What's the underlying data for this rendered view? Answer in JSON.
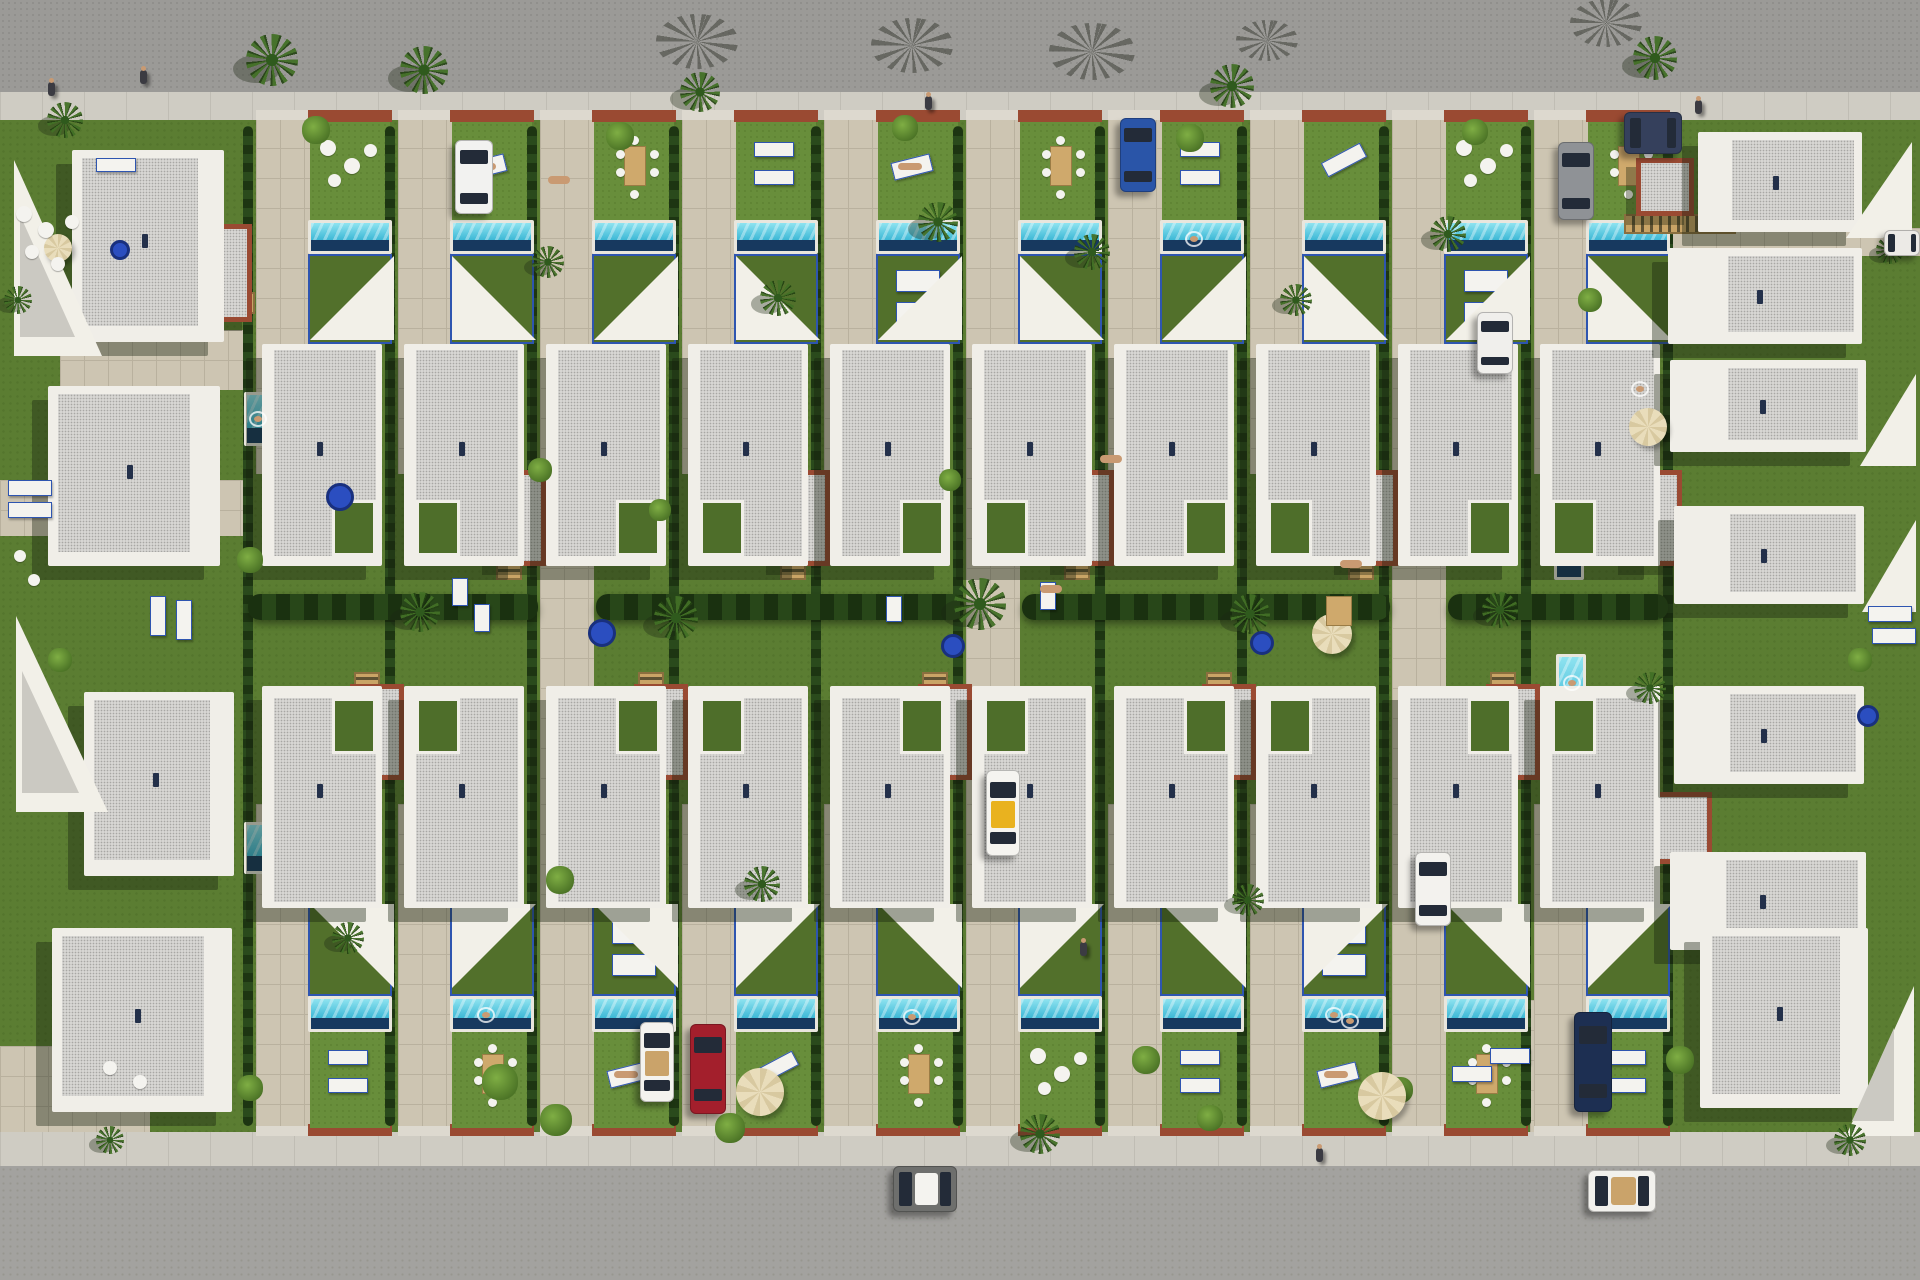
{
  "scene": {
    "kind": "aerial-3d-render",
    "subject": "villa-development-site-plan",
    "width": 1920,
    "height": 1280
  },
  "palette": {
    "road_top": "#9b9a97",
    "road_bottom": "#a3a29f",
    "sidewalk": "#cfccc3",
    "lawn": "#5b7d32",
    "lawn_light": "#688e3b",
    "lawn_terrace": "#52702b",
    "hedge": "#24411a",
    "paving": "#cdc5b2",
    "roof": "#d7d6d3",
    "parapet": "#f0eee8",
    "terracotta": "#9a4a32",
    "wood": "#c9a466",
    "pool": "#3db8d6",
    "pool_deep": "#17395f",
    "coping": "#e9e6dd",
    "sail": "#f2f0e8",
    "frame_blue": "#2e55b0",
    "table_blue": "#2b4ec0",
    "umbrella": "#e6d9b4",
    "taxi_yellow": "#e9b21f",
    "car_red": "#a31f2c",
    "car_navy": "#1d2f52",
    "car_blue": "#2a55a8",
    "skin": "#c99a72"
  },
  "roads": {
    "top": {
      "x": 0,
      "y": 0,
      "w": 1920,
      "h": 92
    },
    "bottom": {
      "x": 0,
      "y": 1166,
      "w": 1920,
      "h": 114
    }
  },
  "sidewalks": {
    "top": {
      "x": 0,
      "y": 92,
      "w": 1920,
      "h": 28
    },
    "bottom": {
      "x": 0,
      "y": 1132,
      "w": 1920,
      "h": 34
    }
  },
  "block": {
    "x": 0,
    "y": 120,
    "w": 1920,
    "h": 1012
  },
  "paving_extra": [
    {
      "x": 540,
      "y": 118,
      "w": 54,
      "h": 1014
    },
    {
      "x": 966,
      "y": 118,
      "w": 54,
      "h": 1014
    },
    {
      "x": 1392,
      "y": 118,
      "w": 54,
      "h": 1014
    },
    {
      "x": 0,
      "y": 480,
      "w": 248,
      "h": 56
    },
    {
      "x": 1620,
      "y": 228,
      "w": 300,
      "h": 28
    },
    {
      "x": 0,
      "y": 1046,
      "w": 150,
      "h": 86
    },
    {
      "x": 1530,
      "y": 1000,
      "w": 140,
      "h": 132
    },
    {
      "x": 60,
      "y": 330,
      "w": 190,
      "h": 60
    }
  ],
  "driveways": {
    "xs": [
      256,
      398,
      540,
      682,
      824,
      966,
      1108,
      1250,
      1392,
      1534
    ],
    "top": {
      "y": 118,
      "h": 356,
      "w": 54
    },
    "bottom": {
      "y": 804,
      "h": 328,
      "w": 54
    }
  },
  "curbs": {
    "terracotta_xs": [
      308,
      450,
      592,
      734,
      876,
      1018,
      1160,
      1302,
      1444,
      1586
    ],
    "light_xs": [
      256,
      398,
      540,
      682,
      824,
      966,
      1108,
      1250,
      1392,
      1534
    ],
    "top_y": 110,
    "bottom_y": 1124,
    "tw": 84,
    "lw": 52,
    "h": 12
  },
  "hedges_v": {
    "xs": [
      243,
      385,
      527,
      669,
      811,
      953,
      1095,
      1237,
      1379,
      1521,
      1663
    ],
    "y": 126,
    "w": 10,
    "h": 1000
  },
  "hedge_mid": [
    {
      "x": 248,
      "y": 594,
      "w": 290,
      "h": 26
    },
    {
      "x": 596,
      "y": 594,
      "w": 368,
      "h": 26
    },
    {
      "x": 1022,
      "y": 594,
      "w": 368,
      "h": 26
    },
    {
      "x": 1448,
      "y": 594,
      "w": 220,
      "h": 26
    }
  ],
  "gardens": {
    "xs": [
      310,
      452,
      594,
      736,
      878,
      1020,
      1162,
      1304,
      1446,
      1588
    ],
    "w": 80,
    "h": 98,
    "top_y": 122,
    "bottom_y": 1030,
    "top_furniture": [
      "roundchairs",
      "sunbed",
      "dining",
      "loungers2",
      "sunbed",
      "dining",
      "loungers2",
      "lounger1",
      "roundchairs",
      "dining"
    ],
    "bottom_furniture": [
      "loungers2",
      "dining",
      "sunbed",
      "lounger1",
      "dining",
      "roundchairs",
      "loungers2",
      "sunbed",
      "dining",
      "loungers2"
    ]
  },
  "pools_h": {
    "xs": [
      308,
      450,
      592,
      734,
      876,
      1018,
      1160,
      1302,
      1444,
      1586
    ],
    "w": 84,
    "top": {
      "y": 220,
      "h": 34
    },
    "bottom": {
      "y": 996,
      "h": 36
    }
  },
  "pools_v": [
    {
      "x": 244,
      "y": 392,
      "w": 26,
      "h": 54
    },
    {
      "x": 244,
      "y": 822,
      "w": 26,
      "h": 52
    },
    {
      "x": 1322,
      "y": 396,
      "w": 30,
      "h": 72
    },
    {
      "x": 1554,
      "y": 496,
      "w": 30,
      "h": 84
    },
    {
      "x": 1556,
      "y": 654,
      "w": 30,
      "h": 90
    },
    {
      "x": 1622,
      "y": 288,
      "w": 30,
      "h": 48
    },
    {
      "x": 1624,
      "y": 360,
      "w": 32,
      "h": 56
    }
  ],
  "terraces": {
    "xs": [
      308,
      450,
      592,
      734,
      876,
      1018,
      1160,
      1302,
      1444,
      1586
    ],
    "w": 84,
    "top": {
      "y": 254,
      "h": 90
    },
    "bottom": {
      "y": 906,
      "h": 90
    },
    "beds_top": [
      876,
      1444
    ],
    "beds_bottom": [
      592,
      1302
    ]
  },
  "sails_row": {
    "top": {
      "y": 256,
      "s": 84,
      "dirs": [
        "se",
        "sw",
        "se",
        "sw",
        "se",
        "sw",
        "se",
        "sw",
        "se",
        "sw"
      ]
    },
    "bottom": {
      "y": 904,
      "s": 84,
      "dirs": [
        "ne",
        "nw",
        "ne",
        "nw",
        "ne",
        "nw",
        "ne",
        "nw",
        "ne",
        "nw"
      ]
    },
    "xs": [
      310,
      452,
      594,
      736,
      878,
      1020,
      1162,
      1304,
      1446,
      1588
    ]
  },
  "houses": {
    "xs": [
      262,
      404,
      546,
      688,
      830,
      972,
      1114,
      1256,
      1398,
      1540
    ],
    "w": 120,
    "h": 222,
    "top_y": 344,
    "bottom_y": 686,
    "top_notches": [
      "br",
      "bl",
      "br",
      "bl",
      "br",
      "bl",
      "br",
      "bl",
      "br",
      "bl"
    ],
    "bottom_notches": [
      "tr",
      "tl",
      "tr",
      "tl",
      "tr",
      "tl",
      "tr",
      "tl",
      "tr",
      "tl"
    ]
  },
  "annexes": [
    {
      "x": 492,
      "y": 470,
      "w": 54,
      "h": 96
    },
    {
      "x": 776,
      "y": 470,
      "w": 54,
      "h": 96
    },
    {
      "x": 1060,
      "y": 470,
      "w": 54,
      "h": 96
    },
    {
      "x": 1344,
      "y": 470,
      "w": 54,
      "h": 96
    },
    {
      "x": 1628,
      "y": 470,
      "w": 54,
      "h": 96
    },
    {
      "x": 350,
      "y": 684,
      "w": 54,
      "h": 96
    },
    {
      "x": 634,
      "y": 684,
      "w": 54,
      "h": 96
    },
    {
      "x": 918,
      "y": 684,
      "w": 54,
      "h": 96
    },
    {
      "x": 1202,
      "y": 684,
      "w": 54,
      "h": 96
    },
    {
      "x": 1486,
      "y": 684,
      "w": 54,
      "h": 96
    },
    {
      "x": 206,
      "y": 224,
      "w": 46,
      "h": 98
    },
    {
      "x": 1636,
      "y": 158,
      "w": 58,
      "h": 58
    },
    {
      "x": 1634,
      "y": 792,
      "w": 78,
      "h": 72
    }
  ],
  "stairs_v": [
    {
      "x": 496,
      "y": 492
    },
    {
      "x": 780,
      "y": 492
    },
    {
      "x": 1064,
      "y": 492
    },
    {
      "x": 1348,
      "y": 492
    },
    {
      "x": 354,
      "y": 672
    },
    {
      "x": 638,
      "y": 672
    },
    {
      "x": 922,
      "y": 672
    },
    {
      "x": 1206,
      "y": 672
    },
    {
      "x": 1490,
      "y": 672
    }
  ],
  "stairs_h": [
    {
      "x": 155,
      "y": 292,
      "w": 100,
      "h": 22
    },
    {
      "x": 1624,
      "y": 214,
      "w": 112,
      "h": 20
    }
  ],
  "villas": [
    {
      "x": 72,
      "y": 150,
      "w": 152,
      "h": 192,
      "wl": 10,
      "wt": 8,
      "wr": 26,
      "wb": 16
    },
    {
      "x": 48,
      "y": 386,
      "w": 172,
      "h": 180,
      "wl": 10,
      "wt": 8,
      "wr": 30,
      "wb": 14
    },
    {
      "x": 84,
      "y": 692,
      "w": 150,
      "h": 184,
      "wl": 10,
      "wt": 8,
      "wr": 24,
      "wb": 16
    },
    {
      "x": 52,
      "y": 928,
      "w": 180,
      "h": 184,
      "wl": 10,
      "wt": 8,
      "wr": 28,
      "wb": 16
    },
    {
      "x": 1698,
      "y": 132,
      "w": 164,
      "h": 100,
      "wl": 34,
      "wt": 8,
      "wr": 8,
      "wb": 12
    },
    {
      "x": 1668,
      "y": 248,
      "w": 194,
      "h": 96,
      "wl": 60,
      "wt": 8,
      "wr": 8,
      "wb": 12
    },
    {
      "x": 1670,
      "y": 360,
      "w": 196,
      "h": 92,
      "wl": 58,
      "wt": 8,
      "wr": 8,
      "wb": 12
    },
    {
      "x": 1674,
      "y": 506,
      "w": 190,
      "h": 98,
      "wl": 56,
      "wt": 8,
      "wr": 8,
      "wb": 12
    },
    {
      "x": 1674,
      "y": 686,
      "w": 190,
      "h": 98,
      "wl": 56,
      "wt": 8,
      "wr": 8,
      "wb": 12
    },
    {
      "x": 1670,
      "y": 852,
      "w": 196,
      "h": 98,
      "wl": 56,
      "wt": 8,
      "wr": 8,
      "wb": 12
    },
    {
      "x": 1700,
      "y": 928,
      "w": 168,
      "h": 180,
      "wl": 12,
      "wt": 8,
      "wr": 28,
      "wb": 14
    }
  ],
  "corner_sails": [
    {
      "x": 14,
      "y": 160,
      "w": 88,
      "h": 196,
      "dir": "sw",
      "shade": true
    },
    {
      "x": 16,
      "y": 616,
      "w": 92,
      "h": 196,
      "dir": "sw",
      "shade": true
    },
    {
      "x": 1846,
      "y": 142,
      "w": 66,
      "h": 96,
      "dir": "se",
      "shade": false
    },
    {
      "x": 1860,
      "y": 374,
      "w": 56,
      "h": 92,
      "dir": "se",
      "shade": false
    },
    {
      "x": 1862,
      "y": 520,
      "w": 54,
      "h": 92,
      "dir": "se",
      "shade": false
    },
    {
      "x": 1846,
      "y": 986,
      "w": 68,
      "h": 150,
      "dir": "se",
      "shade": true
    }
  ],
  "palms": [
    [
      272,
      60,
      26
    ],
    [
      424,
      70,
      24
    ],
    [
      548,
      262,
      16
    ],
    [
      700,
      92,
      20
    ],
    [
      778,
      298,
      18
    ],
    [
      938,
      222,
      20
    ],
    [
      1092,
      252,
      18
    ],
    [
      1232,
      86,
      22
    ],
    [
      1296,
      300,
      16
    ],
    [
      1448,
      234,
      18
    ],
    [
      1655,
      58,
      22
    ],
    [
      420,
      612,
      20
    ],
    [
      676,
      618,
      22
    ],
    [
      980,
      604,
      26
    ],
    [
      1250,
      614,
      20
    ],
    [
      1500,
      610,
      18
    ],
    [
      1650,
      688,
      16
    ],
    [
      348,
      938,
      16
    ],
    [
      762,
      884,
      18
    ],
    [
      1040,
      1134,
      20
    ],
    [
      1248,
      900,
      16
    ],
    [
      110,
      1140,
      14
    ],
    [
      65,
      120,
      18
    ],
    [
      1850,
      1140,
      16
    ],
    [
      18,
      300,
      14
    ],
    [
      1890,
      250,
      14
    ]
  ],
  "palm_shadows": [
    [
      690,
      38,
      34
    ],
    [
      905,
      42,
      34
    ],
    [
      1085,
      48,
      36
    ],
    [
      1262,
      38,
      26
    ],
    [
      1600,
      20,
      30
    ]
  ],
  "bushes": [
    [
      316,
      130,
      14
    ],
    [
      620,
      136,
      14
    ],
    [
      905,
      128,
      13
    ],
    [
      1190,
      138,
      14
    ],
    [
      1475,
      132,
      13
    ],
    [
      1590,
      300,
      12
    ],
    [
      250,
      560,
      13
    ],
    [
      540,
      470,
      12
    ],
    [
      560,
      880,
      14
    ],
    [
      500,
      1082,
      18
    ],
    [
      556,
      1120,
      16
    ],
    [
      730,
      1128,
      15
    ],
    [
      1146,
      1060,
      14
    ],
    [
      1210,
      1118,
      13
    ],
    [
      250,
      1088,
      13
    ],
    [
      1680,
      1060,
      14
    ],
    [
      60,
      660,
      12
    ],
    [
      1860,
      660,
      12
    ],
    [
      950,
      480,
      11
    ],
    [
      660,
      510,
      11
    ],
    [
      1400,
      1090,
      13
    ]
  ],
  "tables_round": [
    [
      340,
      497,
      14
    ],
    [
      602,
      633,
      14
    ],
    [
      953,
      646,
      12
    ],
    [
      1262,
      643,
      12
    ],
    [
      1868,
      716,
      11
    ],
    [
      120,
      250,
      10
    ]
  ],
  "umbrellas": [
    [
      760,
      1092,
      24
    ],
    [
      1382,
      1096,
      24
    ],
    [
      1332,
      634,
      20
    ],
    [
      1648,
      427,
      19
    ],
    [
      58,
      248,
      14
    ]
  ],
  "chairs_white": [
    [
      24,
      214,
      8
    ],
    [
      46,
      230,
      8
    ],
    [
      72,
      222,
      7
    ],
    [
      32,
      252,
      7
    ],
    [
      58,
      264,
      7
    ],
    [
      110,
      1068,
      7
    ],
    [
      140,
      1082,
      7
    ],
    [
      20,
      556,
      6
    ],
    [
      34,
      580,
      6
    ]
  ],
  "loungers_misc": [
    [
      8,
      480,
      44,
      16
    ],
    [
      8,
      502,
      44,
      16
    ],
    [
      150,
      596,
      16,
      40
    ],
    [
      176,
      600,
      16,
      40
    ],
    [
      452,
      578,
      16,
      28
    ],
    [
      474,
      604,
      16,
      28
    ],
    [
      1040,
      582,
      16,
      28
    ],
    [
      886,
      596,
      16,
      26
    ],
    [
      1868,
      606,
      44,
      16
    ],
    [
      1872,
      628,
      44,
      16
    ],
    [
      96,
      158,
      40,
      14
    ],
    [
      1490,
      1048,
      40,
      16
    ],
    [
      1452,
      1066,
      40,
      16
    ]
  ],
  "dining_mid": [
    [
      1326,
      596,
      26,
      30
    ]
  ],
  "cars": [
    {
      "kind": "suv-white",
      "x": 455,
      "y": 140,
      "w": 38,
      "h": 74,
      "dir": "v",
      "body": "#f2f2f0"
    },
    {
      "kind": "sedan-blue",
      "x": 1120,
      "y": 118,
      "w": 36,
      "h": 74,
      "dir": "v",
      "body": "#2a55a8"
    },
    {
      "kind": "sedan-darkblue",
      "x": 1624,
      "y": 112,
      "w": 58,
      "h": 42,
      "dir": "h",
      "body": "#35405c"
    },
    {
      "kind": "sedan-gray",
      "x": 1558,
      "y": 142,
      "w": 36,
      "h": 78,
      "dir": "v",
      "body": "#8f9296"
    },
    {
      "kind": "sedan-white",
      "x": 1477,
      "y": 312,
      "w": 36,
      "h": 62,
      "dir": "v",
      "body": "#f0efec"
    },
    {
      "kind": "car-edge-white",
      "x": 1884,
      "y": 230,
      "w": 36,
      "h": 26,
      "dir": "h",
      "body": "#eceae6"
    },
    {
      "kind": "taxi",
      "x": 986,
      "y": 770,
      "w": 34,
      "h": 86,
      "dir": "v",
      "body": "#f5f4f0",
      "accent": "#e9b21f"
    },
    {
      "kind": "suv-white",
      "x": 1415,
      "y": 852,
      "w": 36,
      "h": 74,
      "dir": "v",
      "body": "#f3f2ee"
    },
    {
      "kind": "sedan-navy",
      "x": 1574,
      "y": 1012,
      "w": 38,
      "h": 100,
      "dir": "v",
      "body": "#1d2f52"
    },
    {
      "kind": "sedan-red",
      "x": 690,
      "y": 1024,
      "w": 36,
      "h": 90,
      "dir": "v",
      "body": "#a31f2c"
    },
    {
      "kind": "convertible-white",
      "x": 640,
      "y": 1022,
      "w": 34,
      "h": 80,
      "dir": "v",
      "body": "#f4f3ef",
      "accent": "#caa36a"
    },
    {
      "kind": "hatchback-road",
      "x": 893,
      "y": 1166,
      "w": 64,
      "h": 46,
      "dir": "h",
      "body": "#6e6f6d",
      "accent": "#f4f3ef"
    },
    {
      "kind": "convertible-road",
      "x": 1588,
      "y": 1170,
      "w": 68,
      "h": 42,
      "dir": "h",
      "body": "#f2f1ed",
      "accent": "#caa36a"
    }
  ],
  "people": [
    [
      48,
      82
    ],
    [
      140,
      70
    ],
    [
      925,
      96
    ],
    [
      1695,
      100
    ],
    [
      1316,
      1148
    ],
    [
      1080,
      942
    ]
  ],
  "sunbathers": [
    [
      548,
      176
    ],
    [
      1340,
      560
    ],
    [
      1040,
      585
    ],
    [
      1100,
      455
    ]
  ],
  "swimmers": [
    [
      482,
      1012
    ],
    [
      908,
      1014
    ],
    [
      1330,
      1012
    ],
    [
      1346,
      1018
    ],
    [
      254,
      416
    ],
    [
      1636,
      386
    ],
    [
      1568,
      680
    ],
    [
      1190,
      236
    ]
  ]
}
